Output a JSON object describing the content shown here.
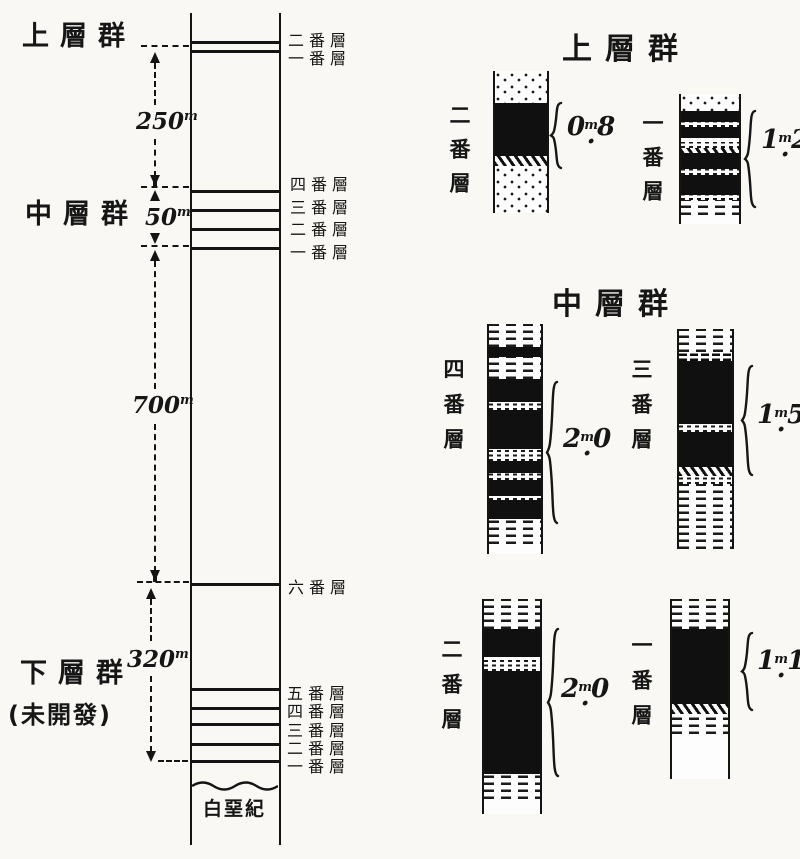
{
  "left_diagram": {
    "groups": {
      "upper": {
        "label": "上層群"
      },
      "middle": {
        "label": "中層群"
      },
      "lower": {
        "label": "下層群",
        "note": "(未開發)"
      }
    },
    "measurements": {
      "upper_thickness": {
        "num": "250",
        "unit": "m"
      },
      "middle_thickness": {
        "num": "50",
        "unit": "m"
      },
      "interval_thickness": {
        "num": "700",
        "unit": "m"
      },
      "lower_thickness": {
        "num": "320",
        "unit": "m"
      }
    },
    "seam_labels_top": [
      "二番層",
      "一番層"
    ],
    "seam_labels_middle": [
      "四番層",
      "三番層",
      "二番層",
      "一番層"
    ],
    "seam_label_six": "六番層",
    "seam_labels_lower": [
      "五番層",
      "四番層",
      "三番層",
      "二番層",
      "一番層"
    ],
    "basement_label": "白堊紀",
    "seam_line_ys": [
      28,
      37,
      177,
      196,
      215,
      234,
      570,
      675,
      694,
      710,
      730,
      747
    ]
  },
  "right_diagram": {
    "section_upper_title": "上層群",
    "section_middle_title": "中層群",
    "columns": {
      "upper2": {
        "label": "二番層",
        "thickness": {
          "int": "0",
          "frac": "8",
          "unit": "m"
        },
        "bands": [
          {
            "t": "sand",
            "h": 32
          },
          {
            "t": "coal",
            "h": 53
          },
          {
            "t": "hatch",
            "h": 10
          },
          {
            "t": "sand",
            "h": 47
          }
        ]
      },
      "upper1": {
        "label": "一番層",
        "thickness": {
          "int": "1",
          "frac": "2",
          "unit": "m"
        },
        "bands": [
          {
            "t": "sand",
            "h": 17
          },
          {
            "t": "coal",
            "h": 11
          },
          {
            "t": "speck",
            "h": 5
          },
          {
            "t": "coal",
            "h": 11
          },
          {
            "t": "white",
            "h": 4
          },
          {
            "t": "speck",
            "h": 6
          },
          {
            "t": "hatch",
            "h": 5
          },
          {
            "t": "coal",
            "h": 16
          },
          {
            "t": "speck",
            "h": 6
          },
          {
            "t": "coal",
            "h": 20
          },
          {
            "t": "speck",
            "h": 5
          },
          {
            "t": "shaledash",
            "h": 15
          },
          {
            "t": "white",
            "h": 9
          }
        ]
      },
      "middle4": {
        "label": "四番層",
        "thickness": {
          "int": "2",
          "frac": "0",
          "unit": "m"
        },
        "bands": [
          {
            "t": "shaledash",
            "h": 23
          },
          {
            "t": "coal",
            "h": 10
          },
          {
            "t": "shaledash",
            "h": 22
          },
          {
            "t": "coal",
            "h": 23
          },
          {
            "t": "speck",
            "h": 8
          },
          {
            "t": "coal",
            "h": 39
          },
          {
            "t": "speck",
            "h": 12
          },
          {
            "t": "coal",
            "h": 12
          },
          {
            "t": "speck",
            "h": 7
          },
          {
            "t": "coal",
            "h": 16
          },
          {
            "t": "speck",
            "h": 4
          },
          {
            "t": "coal",
            "h": 19
          },
          {
            "t": "shaledash",
            "h": 25
          },
          {
            "t": "white",
            "h": 10
          }
        ]
      },
      "middle3": {
        "label": "三番層",
        "thickness": {
          "int": "1",
          "frac": "5",
          "unit": "m"
        },
        "bands": [
          {
            "t": "shaledash",
            "h": 23
          },
          {
            "t": "speckdark",
            "h": 9
          },
          {
            "t": "coal",
            "h": 63
          },
          {
            "t": "speck",
            "h": 8
          },
          {
            "t": "coal",
            "h": 35
          },
          {
            "t": "hatch",
            "h": 9
          },
          {
            "t": "speck",
            "h": 8
          },
          {
            "t": "shaledash",
            "h": 65
          }
        ]
      },
      "middle2": {
        "label": "二番層",
        "thickness": {
          "int": "2",
          "frac": "0",
          "unit": "m"
        },
        "bands": [
          {
            "t": "shaledash",
            "h": 30
          },
          {
            "t": "coal",
            "h": 28
          },
          {
            "t": "speck",
            "h": 14
          },
          {
            "t": "coal",
            "h": 103
          },
          {
            "t": "shaledash",
            "h": 25
          },
          {
            "t": "white",
            "h": 15
          }
        ]
      },
      "middle1": {
        "label": "一番層",
        "thickness": {
          "int": "1",
          "frac": "1",
          "unit": "m"
        },
        "bands": [
          {
            "t": "shaledash",
            "h": 30
          },
          {
            "t": "coal",
            "h": 75
          },
          {
            "t": "hatch",
            "h": 10
          },
          {
            "t": "shaledash",
            "h": 20
          },
          {
            "t": "white",
            "h": 45
          }
        ]
      }
    }
  }
}
